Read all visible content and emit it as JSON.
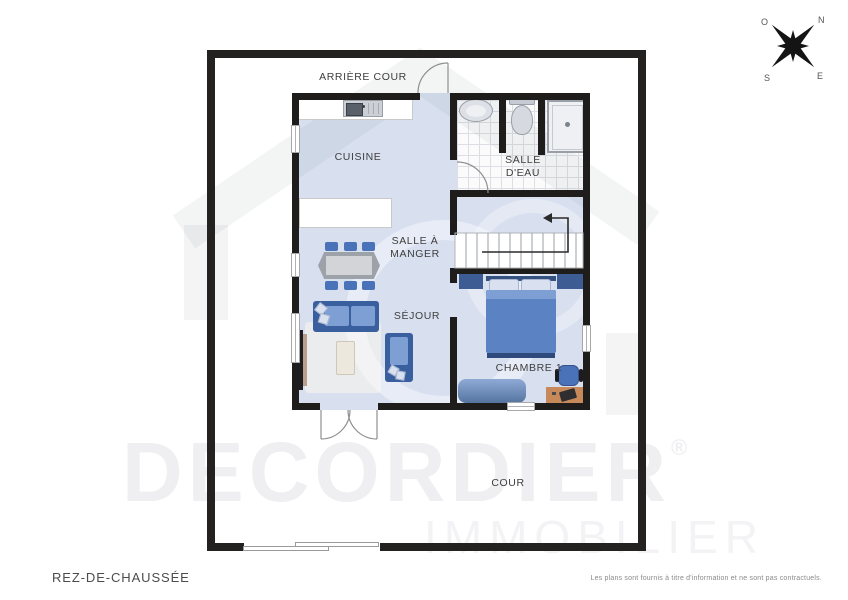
{
  "compass": {
    "n": "N",
    "o": "O",
    "s": "S",
    "e": "E"
  },
  "watermark": {
    "brand": "DECORDIER",
    "registered": "®",
    "sub": "IMMOBILIER"
  },
  "rooms": {
    "arriere_cour": {
      "label": "ARRIÈRE COUR"
    },
    "cuisine": {
      "label": "CUISINE"
    },
    "salle_deau": {
      "line1": "SALLE",
      "line2": "D'EAU"
    },
    "salle_a_manger": {
      "line1": "SALLE À",
      "line2": "MANGER"
    },
    "sejour": {
      "label": "SÉJOUR"
    },
    "chambre_1": {
      "label": "CHAMBRE 1"
    },
    "cour": {
      "label": "COUR"
    }
  },
  "footer": {
    "floor_title": "REZ-DE-CHAUSSÉE",
    "disclaimer": "Les plans sont fournis à titre d'information et ne sont pas contractuels."
  },
  "colors": {
    "wall": "#1f1d1c",
    "outer_wall": "#242220",
    "floor_blue": "#d8e0f0",
    "furniture_blue": "#4a72b8",
    "furniture_blue_dark": "#3a5f9f",
    "bed_blue": "#5b83c4",
    "desk_wood": "#c8895a",
    "label_text": "#3e3e3e"
  }
}
